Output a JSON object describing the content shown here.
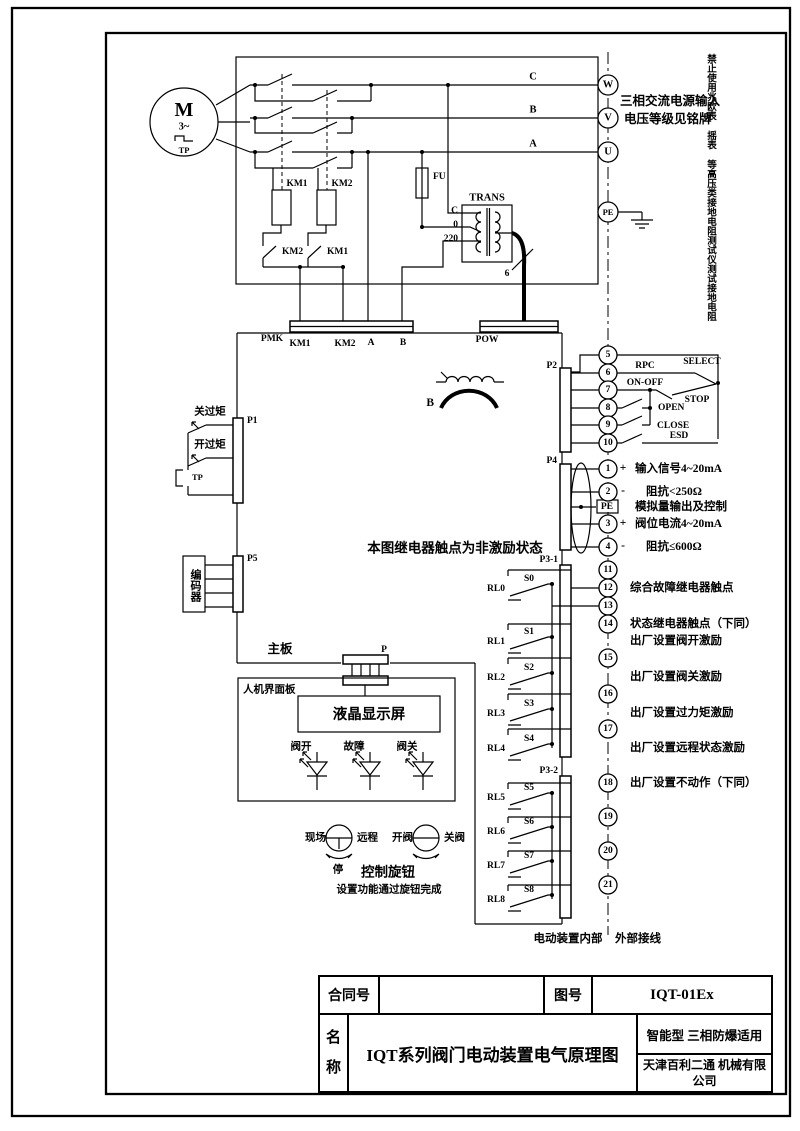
{
  "frame": {
    "warning": "禁止使用兆欧表 摇表 等高压类接地电阻测试仪测试接地电阻"
  },
  "power": {
    "motor_m": "M",
    "motor_phase": "3~",
    "motor_tp": "TP",
    "phase_c": "C",
    "phase_b": "B",
    "phase_a": "A",
    "term_w": "W",
    "term_v": "V",
    "term_u": "U",
    "term_pe": "PE",
    "note1": "三相交流电源输入",
    "note2": "电压等级见铭牌",
    "km1_coil": "KM1",
    "km2_coil": "KM2",
    "km1_aux": "KM1",
    "km2_aux": "KM2",
    "fu": "FU",
    "trans": "TRANS",
    "pin_c": "C",
    "pin_0": "0",
    "pin_220": "220",
    "cable6": "6"
  },
  "strips": {
    "pmk": "PMK",
    "km1": "KM1",
    "km2": "KM2",
    "a": "A",
    "b": "B",
    "pow": "POW"
  },
  "board": {
    "label": "主板",
    "note": "本图继电器触点为非激励状态",
    "ct_b": "B",
    "p": "P"
  },
  "left": {
    "p1": "P1",
    "close_torque": "关过矩",
    "open_torque": "开过矩",
    "tp": "TP",
    "p5": "P5",
    "encoder": "编码器"
  },
  "p2": {
    "label": "P2",
    "t": [
      "5",
      "6",
      "7",
      "8",
      "9",
      "10"
    ],
    "rpc": "RPC",
    "select": "SELECT",
    "onoff": "ON-OFF",
    "stop": "STOP",
    "open": "OPEN",
    "close": "CLOSE",
    "esd": "ESD"
  },
  "p4": {
    "label": "P4",
    "t": [
      "1",
      "2",
      "3",
      "4"
    ],
    "pe": "PE",
    "plus": "+",
    "minus": "-",
    "l1": "输入信号4~20mA",
    "l2": "阻抗<250Ω",
    "l3": "模拟量输出及控制",
    "l4": "阀位电流4~20mA",
    "l5": "阻抗≤600Ω"
  },
  "p31": {
    "label": "P3-1",
    "t": [
      "11",
      "12",
      "13",
      "14",
      "15",
      "16",
      "17"
    ],
    "n1": "综合故障继电器触点",
    "n2": "状态继电器触点（下同）",
    "n3": "出厂设置阀开激励",
    "n4": "出厂设置阀关激励",
    "n5": "出厂设置过力矩激励",
    "n6": "出厂设置远程状态激励"
  },
  "p32": {
    "label": "P3-2",
    "t": [
      "18",
      "19",
      "20",
      "21"
    ],
    "n1": "出厂设置不动作（下同）"
  },
  "relays": [
    {
      "rl": "RL0",
      "s": "S0"
    },
    {
      "rl": "RL1",
      "s": "S1"
    },
    {
      "rl": "RL2",
      "s": "S2"
    },
    {
      "rl": "RL3",
      "s": "S3"
    },
    {
      "rl": "RL4",
      "s": "S4"
    },
    {
      "rl": "RL5",
      "s": "S5"
    },
    {
      "rl": "RL6",
      "s": "S6"
    },
    {
      "rl": "RL7",
      "s": "S7"
    },
    {
      "rl": "RL8",
      "s": "S8"
    }
  ],
  "hmi": {
    "label": "人机界面板",
    "lcd": "液晶显示屏",
    "led1": "阀开",
    "led2": "故障",
    "led3": "阀关",
    "k1l": "现场",
    "k1r": "远程",
    "k1d": "停",
    "k2l": "开阀",
    "k2r": "关阀",
    "knob": "控制旋钮",
    "knob_note": "设置功能通过旋钮完成"
  },
  "footer": {
    "internal": "电动装置内部",
    "external": "外部接线"
  },
  "title_block": {
    "contract_label": "合同号",
    "contract_value": "",
    "fig_label": "图号",
    "fig_value": "IQT-01Ex",
    "name_label": "名\n称",
    "name_value": "IQT系列阀门电动装置电气原理图",
    "type_note": "智能型  三相防爆适用",
    "company": "天津百利二通\n机械有限公司"
  }
}
